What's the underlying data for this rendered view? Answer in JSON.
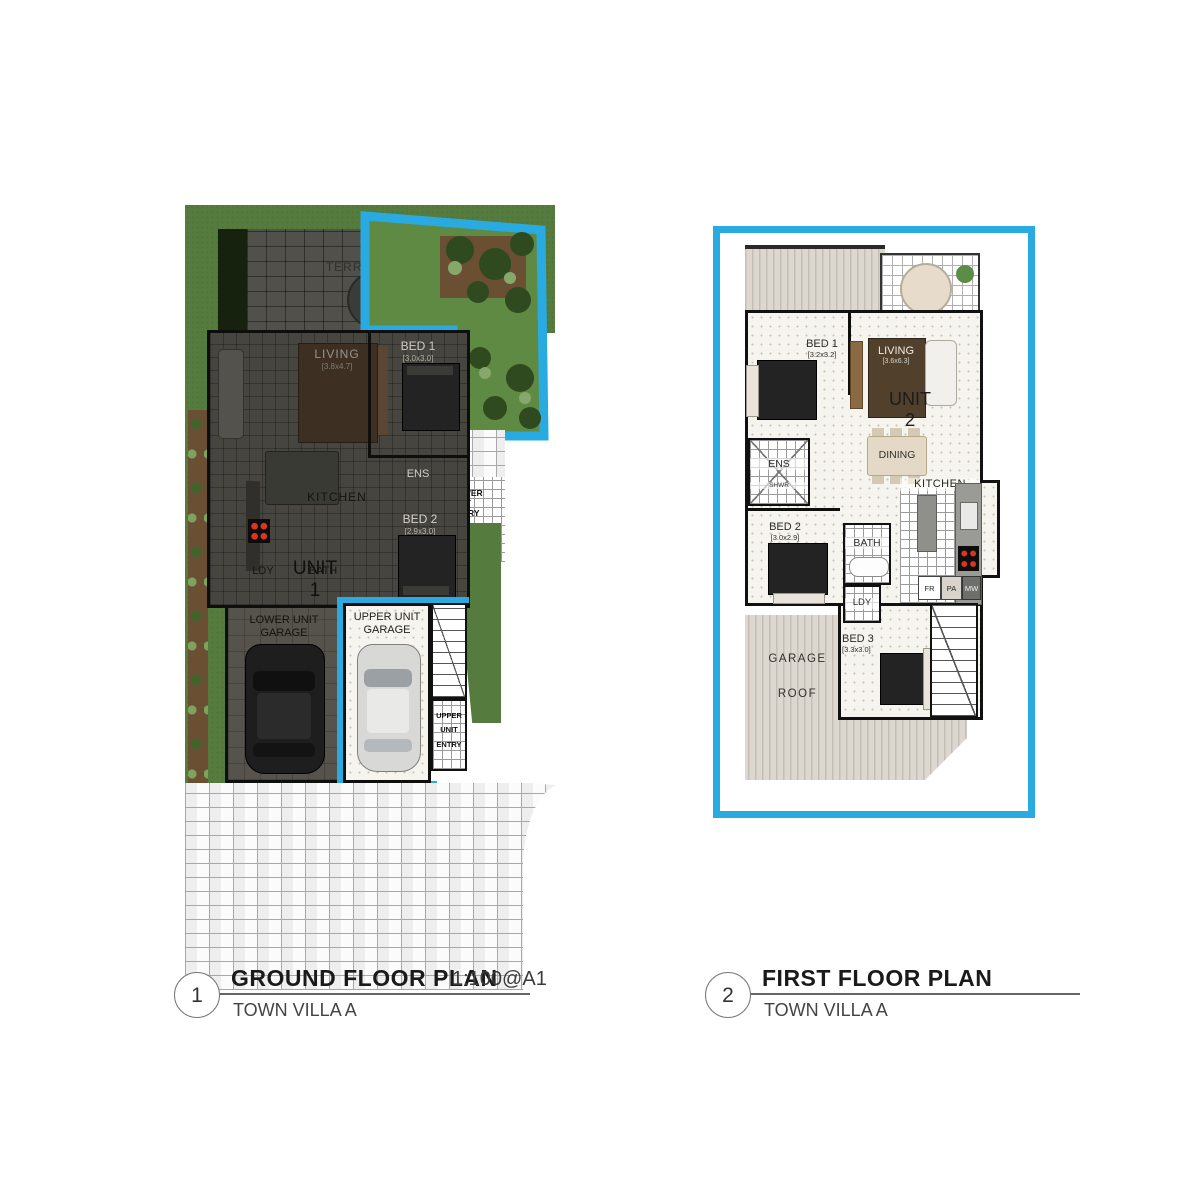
{
  "accent": "#29abe2",
  "gf": {
    "number": "1",
    "title": "GROUND FLOOR PLAN",
    "scale": "1:100@A1",
    "subtitle": "TOWN VILLA A",
    "terrace": "TERRACE",
    "living": "LIVING",
    "living_dims": "[3.8x4.7]",
    "bed1": "BED 1",
    "bed1_dims": "[3.0x3.0]",
    "unit1": {
      "l1": "UNIT",
      "l2": "1"
    },
    "ens": "ENS",
    "kitchen": "KITCHEN",
    "ldy": "LDY",
    "bath": "BATH",
    "bed2": "BED 2",
    "bed2_dims": "[2.9x3.0]",
    "lower_entry": {
      "l1": "LOWER",
      "l2": "UNIT",
      "l3": "ENTRY"
    },
    "upper_entry": {
      "l1": "UPPER",
      "l2": "UNIT",
      "l3": "ENTRY"
    },
    "lower_garage": {
      "l1": "LOWER UNIT",
      "l2": "GARAGE"
    },
    "upper_garage": {
      "l1": "UPPER UNIT",
      "l2": "GARAGE"
    }
  },
  "ff": {
    "number": "2",
    "title": "FIRST FLOOR PLAN",
    "subtitle": "TOWN VILLA A",
    "balcony": "BALCONY",
    "balcony_dims": "[3.6 x 2.8]",
    "bed1": "BED 1",
    "bed1_dims": "[3.2x3.2]",
    "living": "LIVING",
    "living_dims": "[3.6x6.3]",
    "unit2": {
      "l1": "UNIT",
      "l2": "2"
    },
    "dining": "DINING",
    "ens": "ENS",
    "shwr": "SHWR",
    "kitchen": "KITCHEN",
    "bed2": "BED 2",
    "bed2_dims": "[3.0x2.9]",
    "bath": "BATH",
    "ldy": "LDY",
    "fr": "FR",
    "pa": "PA",
    "mw": "MW",
    "bed3": "BED 3",
    "bed3_dims": "[3.3x3.0]",
    "garage_roof": {
      "l1": "GARAGE",
      "l2": "ROOF"
    }
  }
}
